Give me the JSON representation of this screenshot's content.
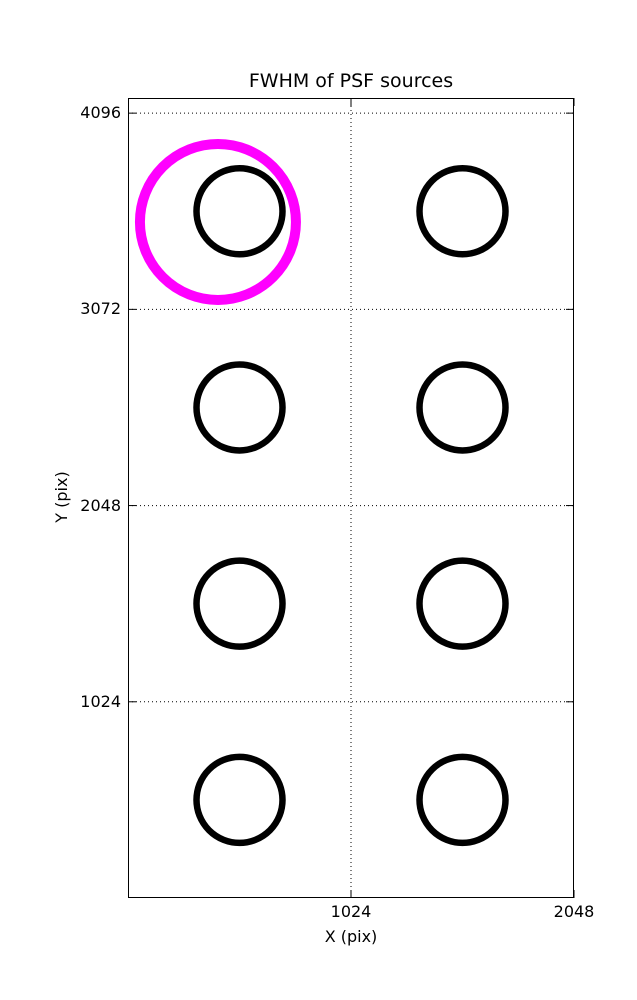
{
  "figure": {
    "background": "#ffffff",
    "foreground": "#000000"
  },
  "chart_data": {
    "type": "scatter",
    "title": "FWHM of PSF sources",
    "xlabel": "X (pix)",
    "ylabel": "Y (pix)",
    "xlim": [
      0,
      2048
    ],
    "ylim": [
      0,
      4175
    ],
    "xticks": [
      1024,
      2048
    ],
    "yticks": [
      1024,
      2048,
      3072,
      4096
    ],
    "grid": true,
    "grid_style": "dotted",
    "grid_color": "#000000",
    "legend": "none",
    "series": [
      {
        "name": "psf-sources",
        "marker": "open-circle",
        "color": "#000000",
        "marker_radius_px": 43,
        "line_width_px": 6.5,
        "points": [
          [
            512,
            3584
          ],
          [
            1536,
            3584
          ],
          [
            512,
            2560
          ],
          [
            1536,
            2560
          ],
          [
            512,
            1536
          ],
          [
            1536,
            1536
          ],
          [
            512,
            512
          ],
          [
            1536,
            512
          ]
        ]
      },
      {
        "name": "highlighted-source",
        "marker": "open-circle",
        "color": "#ff00ff",
        "marker_radius_px": 78,
        "line_width_px": 10,
        "points": [
          [
            413,
            3528
          ]
        ]
      }
    ]
  }
}
